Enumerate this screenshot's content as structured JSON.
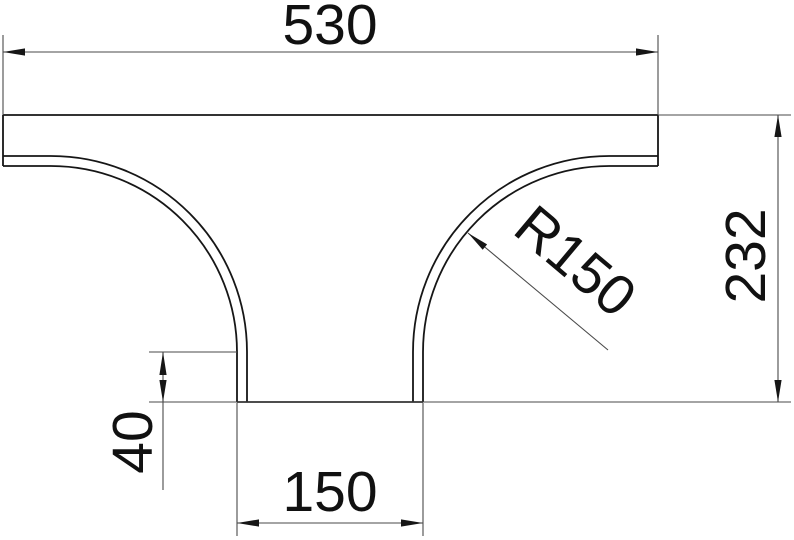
{
  "drawing": {
    "background": "#ffffff",
    "outline_color": "#161616",
    "dimension_color": "#4a4a4a",
    "dimensions": {
      "overall_width": "530",
      "overall_height": "232",
      "bend_radius": "R150",
      "branch_stub_length": "40",
      "branch_width": "150"
    }
  }
}
